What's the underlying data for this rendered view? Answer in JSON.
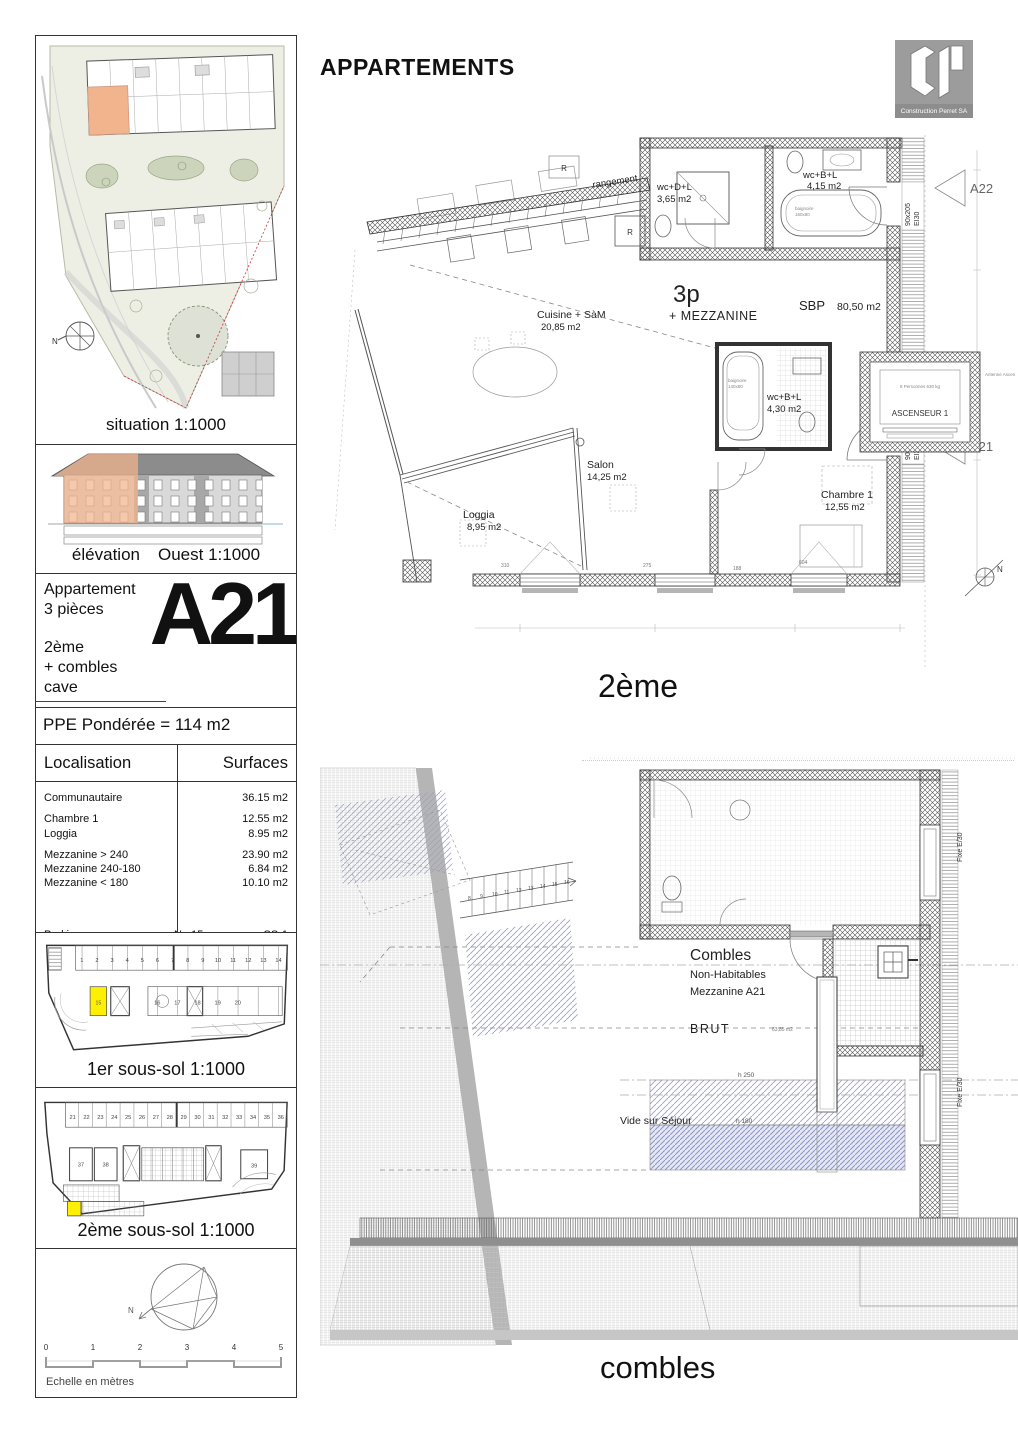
{
  "header": {
    "title": "APPARTEMENTS",
    "logo_company": "Construction Perret SA"
  },
  "colors": {
    "highlight_yellow": "#ffef00",
    "highlight_orange": "#f2b48c",
    "mezzanine_blue": "#8d93c8"
  },
  "sidebar": {
    "situation": {
      "caption": "situation 1:1000",
      "north": "N"
    },
    "elevation": {
      "caption": "élévation",
      "caption2": "Ouest 1:1000"
    },
    "unit": {
      "line1": "Appartement",
      "line2": "3 pièces",
      "line3": "2ème",
      "line4": "+ combles",
      "line5": "cave",
      "code": "A21"
    },
    "ppe": "PPE Pondérée = 114 m2",
    "surfaces": {
      "col_label": "Localisation",
      "col_value": "Surfaces",
      "rows": [
        {
          "label": "Communautaire",
          "value": "36.15 m2"
        },
        {
          "label": "Chambre 1",
          "value": "12.55 m2"
        },
        {
          "label": "Loggia",
          "value": "8.95 m2"
        },
        {
          "label": "Mezzanine > 240",
          "value": "23.90 m2"
        },
        {
          "label": "Mezzanine 240-180",
          "value": "6.84 m2"
        },
        {
          "label": "Mezzanine < 180",
          "value": "10.10 m2"
        }
      ],
      "parking_label": "Parking",
      "parking_no": "No 15",
      "parking_level": "SS-1",
      "cave_label": "Cave",
      "cave_no": "No C14",
      "cave_value": "4.80 m2"
    },
    "ss1": {
      "caption": "1er sous-sol 1:1000",
      "stalls_top": [
        "1",
        "2",
        "3",
        "4",
        "5",
        "6",
        "7",
        "8",
        "9",
        "10",
        "11",
        "12",
        "13",
        "14"
      ],
      "stall_highlight": "15",
      "stalls_mid": [
        "16",
        "17",
        "18",
        "19",
        "20"
      ]
    },
    "ss2": {
      "caption": "2ème sous-sol 1:1000",
      "stalls_top": [
        "21",
        "22",
        "23",
        "24",
        "25",
        "26",
        "27",
        "28",
        "29",
        "30",
        "31",
        "32",
        "33",
        "34",
        "35",
        "36"
      ],
      "stalls_mid": [
        "37",
        "38",
        "39"
      ]
    },
    "scale": {
      "ticks": [
        "0",
        "1",
        "2",
        "3",
        "4",
        "5"
      ],
      "caption": "Echelle en mètres"
    }
  },
  "plan_2eme": {
    "caption": "2ème",
    "rooms": {
      "rangement": "rangement",
      "fridge": "R",
      "fridge2": "R",
      "cuisine": "Cuisine + SàM",
      "cuisine_area": "20,85 m2",
      "wc1": "wc+D+L",
      "wc1_area": "3,65 m2",
      "wc2": "wc+B+L",
      "wc2_area": "4,15 m2",
      "wc3": "wc+B+L",
      "wc3_area": "4,30 m2",
      "baignoire1": "baignoire",
      "baignoire1_size": "160x80",
      "baignoire2": "baignoire",
      "baignoire2_size": "140x80",
      "salon": "Salon",
      "salon_area": "14,25 m2",
      "loggia": "Loggia",
      "loggia_area": "8,95 m2",
      "chambre": "Chambre 1",
      "chambre_area": "12,55 m2",
      "type": "3p",
      "type_sub": "+ MEZZANINE",
      "sbp": "SBP",
      "sbp_area": "80,50 m2",
      "ascenseur": "ASCENSEUR 1",
      "ascenseur_sub": "8 Personnes 630 kg",
      "antenne": "Antenne Ascenseur (P) EI30"
    },
    "doors": {
      "d1": "90x205",
      "d1b": "EI30",
      "d2": "90x205",
      "d2b": "EI30"
    },
    "refs": {
      "a22": "A22",
      "a21": "A21"
    },
    "dims": {
      "d275": "275",
      "d188": "188",
      "d604": "604",
      "d310": "310"
    },
    "north": "N"
  },
  "plan_combles": {
    "caption": "combles",
    "labels": {
      "title": "Combles",
      "sub1": "Non-Habitables",
      "sub2": "Mezzanine A21",
      "brut": "BRUT",
      "brut_area": "63,85 m2",
      "h250": "h 250",
      "h180": "h 180",
      "vide": "Vide sur Séjour",
      "fixe1": "Fixe E/30",
      "fixe2": "Fixe E/30",
      "stairs": [
        "8",
        "9",
        "10",
        "11",
        "12",
        "13",
        "14",
        "15",
        "16"
      ]
    }
  }
}
